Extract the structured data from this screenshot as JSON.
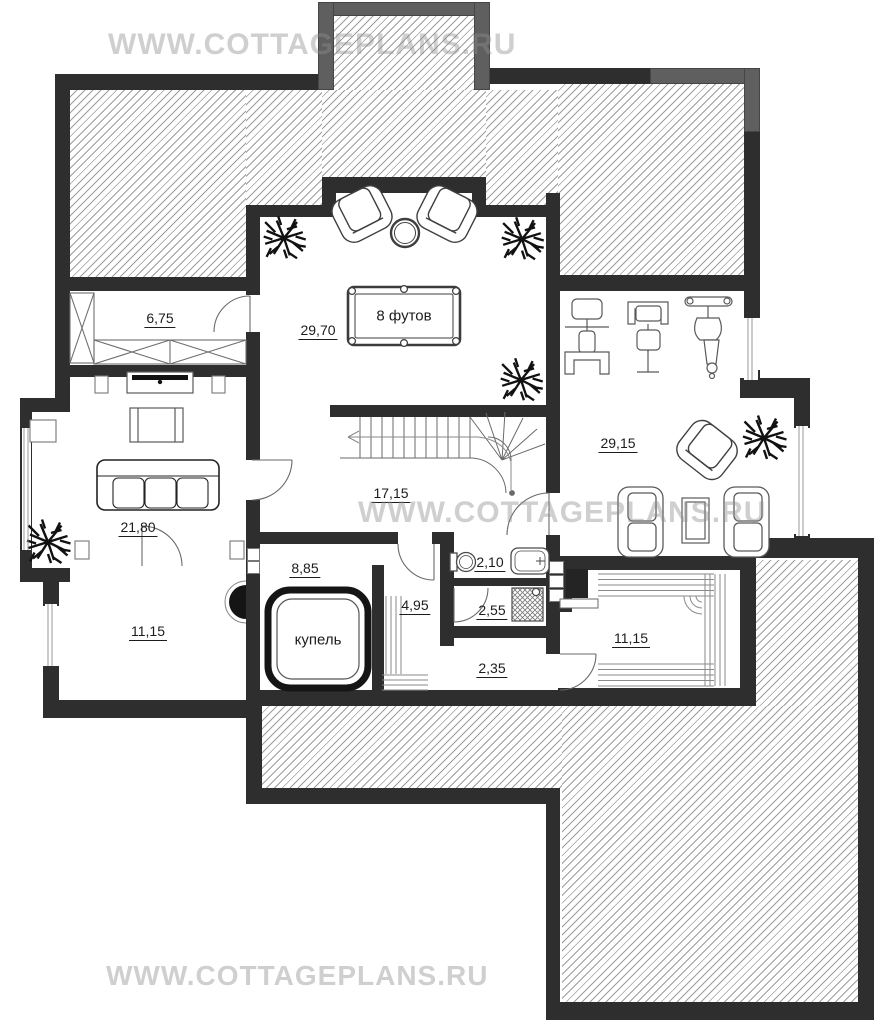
{
  "watermark": {
    "text": "WWW.COTTAGEPLANS.RU"
  },
  "labels": {
    "storage_top": "6,75",
    "billiard": "29,70",
    "billiard_table": "8 футов",
    "stairs_hall": "17,15",
    "gym": "29,15",
    "living": "21,80",
    "bath": "2,10",
    "plunge_room": "8,85",
    "plunge_pool": "купель",
    "steam": "4,95",
    "shower": "2,55",
    "room_bottom_left": "11,15",
    "corridor": "2,35",
    "sauna": "11,15"
  },
  "colors": {
    "wall_dark": "#2e2e2e",
    "wall_light": "#5f5f5f",
    "hatch_line": "#9c9c9c",
    "watermark_gray": "#8f8f8f",
    "label_text": "#1c1c1c"
  }
}
